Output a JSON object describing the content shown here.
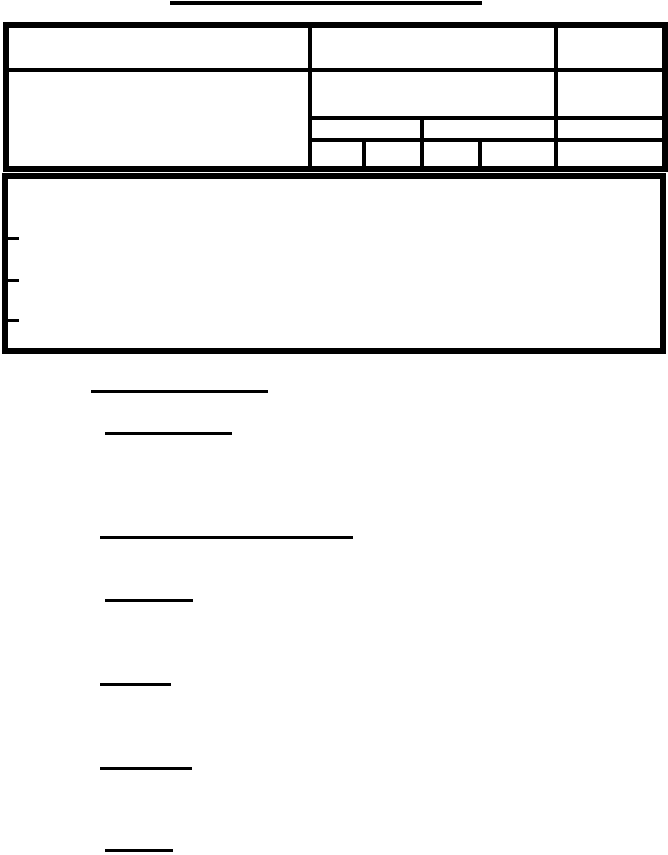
{
  "colors": {
    "paper": "#ffffff",
    "ink": "#000000"
  },
  "title_rule": {
    "name": "title-underline",
    "x": 170,
    "y": 1,
    "w": 312,
    "h": 4
  },
  "header_table": {
    "frame": {
      "name": "header-table-frame",
      "x": 3,
      "y": 22,
      "w": 665,
      "h": 150,
      "border": 6
    },
    "dividers": [
      {
        "name": "header-row-divider",
        "x": 9,
        "y": 68,
        "w": 653,
        "h": 4
      },
      {
        "name": "left-column-divider",
        "x": 308,
        "y": 28,
        "w": 4,
        "h": 138
      },
      {
        "name": "right-column-divider",
        "x": 554,
        "y": 28,
        "w": 4,
        "h": 138
      },
      {
        "name": "middle-row-divider-upper",
        "x": 312,
        "y": 116,
        "w": 350,
        "h": 4
      },
      {
        "name": "middle-row-divider-lower",
        "x": 312,
        "y": 138,
        "w": 350,
        "h": 4
      },
      {
        "name": "sub-column-divider-a",
        "x": 362,
        "y": 142,
        "w": 4,
        "h": 24
      },
      {
        "name": "sub-column-divider-b",
        "x": 420,
        "y": 120,
        "w": 4,
        "h": 46
      },
      {
        "name": "sub-column-divider-c",
        "x": 478,
        "y": 142,
        "w": 4,
        "h": 24
      }
    ]
  },
  "notes_box": {
    "frame": {
      "name": "notes-box-frame",
      "x": 2,
      "y": 173,
      "w": 664,
      "h": 181,
      "border": 6
    },
    "dashes": [
      {
        "name": "list-dash-1",
        "x": 7,
        "y": 237,
        "w": 12,
        "h": 3
      },
      {
        "name": "list-dash-2",
        "x": 7,
        "y": 279,
        "w": 12,
        "h": 3
      },
      {
        "name": "list-dash-3",
        "x": 7,
        "y": 319,
        "w": 12,
        "h": 3
      }
    ]
  },
  "fill_lines": [
    {
      "name": "fill-line-1",
      "x": 91,
      "y": 390,
      "w": 177,
      "h": 3
    },
    {
      "name": "fill-line-2",
      "x": 105,
      "y": 432,
      "w": 127,
      "h": 3
    },
    {
      "name": "fill-line-3",
      "x": 100,
      "y": 536,
      "w": 253,
      "h": 3
    },
    {
      "name": "fill-line-4",
      "x": 105,
      "y": 599,
      "w": 88,
      "h": 3
    },
    {
      "name": "fill-line-5",
      "x": 100,
      "y": 683,
      "w": 71,
      "h": 3
    },
    {
      "name": "fill-line-6",
      "x": 100,
      "y": 767,
      "w": 92,
      "h": 3
    },
    {
      "name": "fill-line-7",
      "x": 105,
      "y": 849,
      "w": 68,
      "h": 3
    }
  ]
}
